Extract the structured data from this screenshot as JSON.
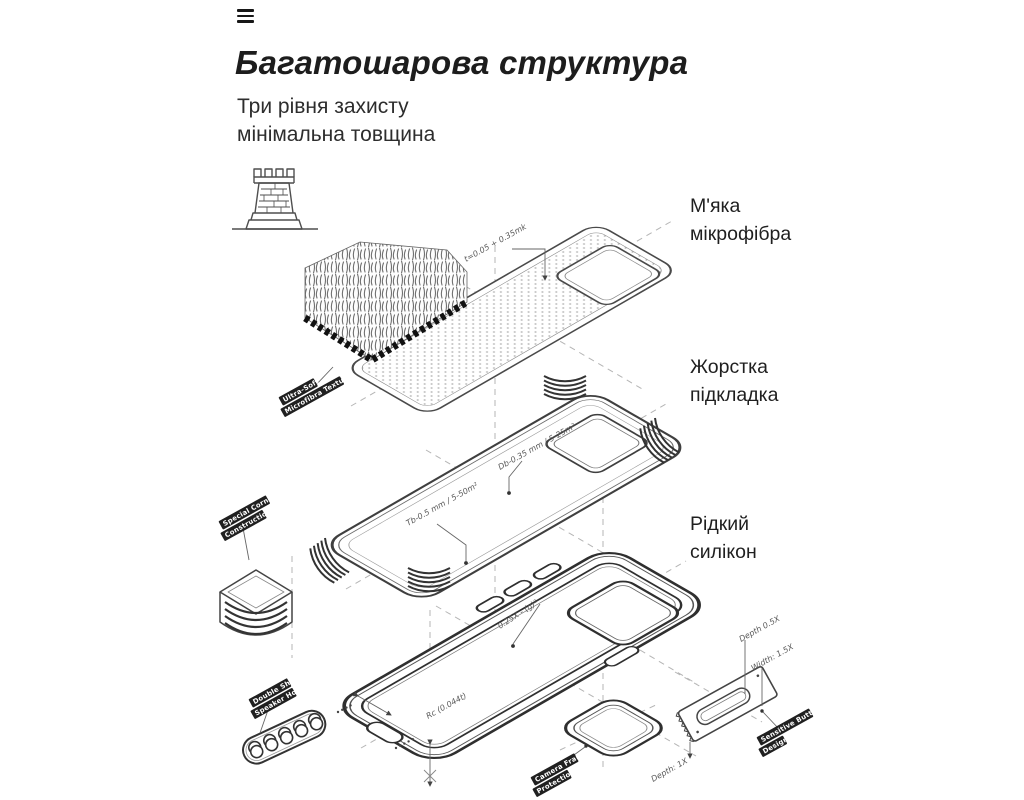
{
  "header": {
    "title": "Багатошарова структура",
    "subtitle_line1": "Три рівня захисту",
    "subtitle_line2": "мінімальна товщина"
  },
  "callouts": {
    "microfiber": {
      "line1": "М'яка",
      "line2": "мікрофібра"
    },
    "lining": {
      "line1": "Жорстка",
      "line2": "підкладка"
    },
    "silicone": {
      "line1": "Рідкий",
      "line2": "силікон"
    }
  },
  "diagram": {
    "badges": {
      "ultra_soft": {
        "line1": "Ultra-Soft",
        "line2": "Microfibra Texture"
      },
      "corner": {
        "line1": "Special Corner",
        "line2": "Construction"
      },
      "speaker": {
        "line1": "Double Shot",
        "line2": "Speaker Hole"
      },
      "camera": {
        "line1": "Camera Frame",
        "line2": "Protection"
      },
      "button": {
        "line1": "Sensitive Button",
        "line2": "Design"
      }
    },
    "annotations": {
      "microfiber_thickness": "t=0.05 + 0.35mk",
      "lining_spec_1": "Db-0.35 mm / 5-25m²",
      "lining_spec_2": "Tb-0.5 mm / 5-50m²",
      "button_radius": "0.25X - (g)²",
      "case_radius": "Rc (0.044t)",
      "button_depth": "Depth 0.5X",
      "button_width": "Width: 1.5X",
      "camera_depth": "Depth: 1X"
    },
    "icons": {
      "menu": "hamburger-menu-icon",
      "tower": "castle-tower-icon"
    }
  },
  "colors": {
    "background": "#ffffff",
    "text_primary": "#1d1d1d",
    "line_art": "#4a4a4a",
    "line_art_dark": "#2f2f2f",
    "dashed_guide": "#b5b5b5",
    "badge_bg": "#202020",
    "badge_text": "#ffffff"
  }
}
